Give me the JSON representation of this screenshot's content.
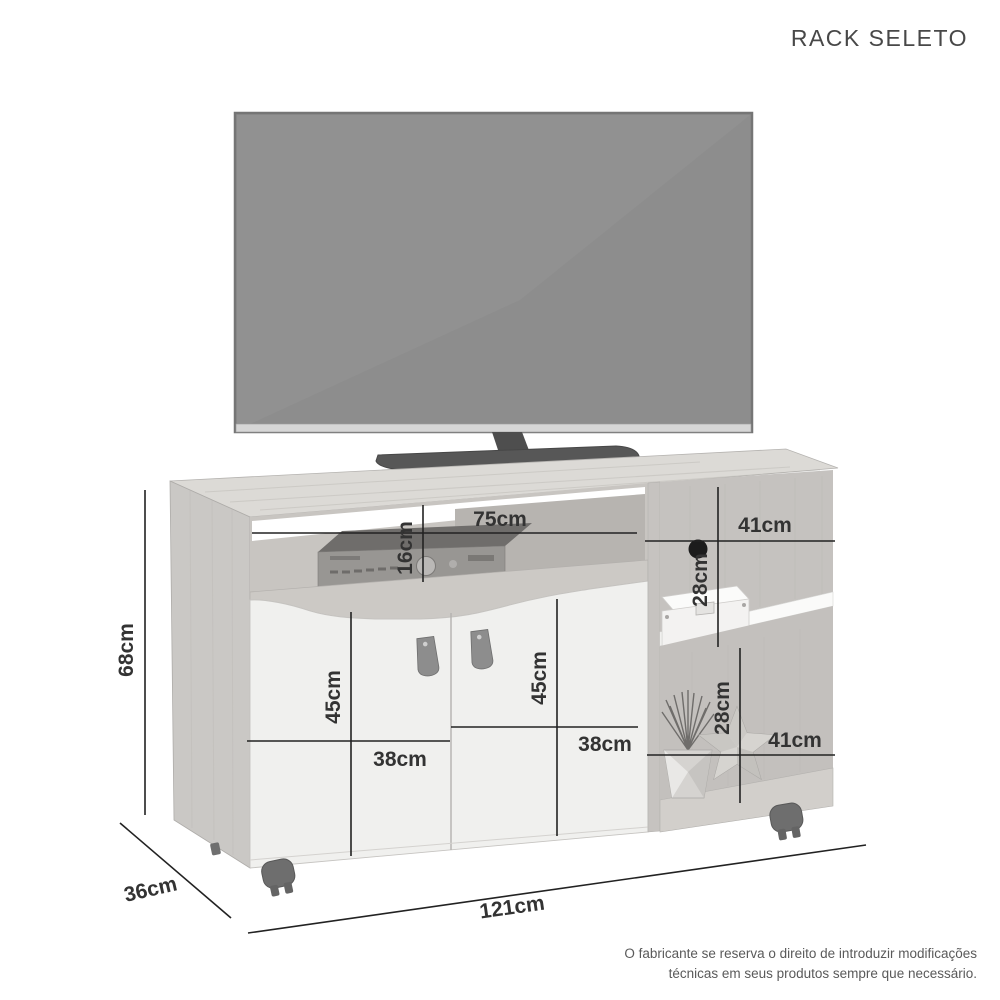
{
  "title": "RACK SELETO",
  "dimensions": {
    "total_height": "68cm",
    "total_depth": "36cm",
    "total_width": "121cm",
    "top_shelf_width": "75cm",
    "top_shelf_height": "16cm",
    "upper_right_width": "41cm",
    "upper_right_height": "28cm",
    "lower_right_height": "28cm",
    "lower_right_width": "41cm",
    "left_door_height": "45cm",
    "left_door_width": "38cm",
    "right_door_height": "45cm",
    "right_door_width": "38cm"
  },
  "disclaimer": {
    "line1": "O fabricante se reserva o direito de introduzir modificações",
    "line2": "técnicas em seus produtos sempre que necessário."
  },
  "colors": {
    "background": "#ffffff",
    "wood_top": "#dcdad6",
    "wood_side": "#cac8c5",
    "wood_interior": "#c5c2bf",
    "door_white": "#f0f0ee",
    "shelf_white": "#fafaf9",
    "tv_screen": "#8d8d8d",
    "tv_base": "#575757",
    "dimension_line": "#222222",
    "label_text": "#333333"
  }
}
